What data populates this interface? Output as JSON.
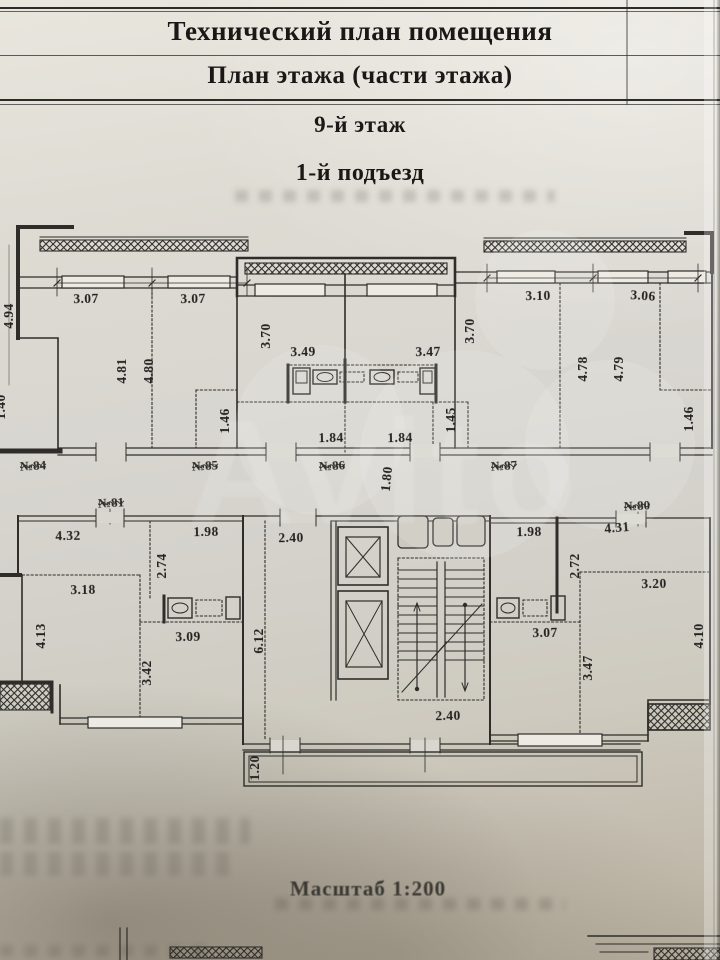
{
  "header": {
    "title": "Технический план помещения",
    "subtitle": "План этажа (части этажа)",
    "floor": "9-й этаж",
    "entrance": "1-й подъезд"
  },
  "footer": {
    "scale": "Масштаб 1:200"
  },
  "watermark": {
    "text": "Avito"
  },
  "plan": {
    "apartments": {
      "a84": "№84",
      "a85": "№85",
      "a86": "№86",
      "a87": "№87",
      "a81": "№81",
      "a80": "№80"
    },
    "dims": {
      "u_494": "4.94",
      "u_307a": "3.07",
      "u_307b": "3.07",
      "u_370a": "3.70",
      "u_349": "3.49",
      "u_347": "3.47",
      "u_370b": "3.70",
      "u_310": "3.10",
      "u_306": "3.06",
      "u_481": "4.81",
      "u_480": "4.80",
      "u_478": "4.78",
      "u_479": "4.79",
      "u_140": "1.40",
      "u_146a": "1.46",
      "u_184a": "1.84",
      "u_184b": "1.84",
      "u_145": "1.45",
      "u_146b": "1.46",
      "u_180": "1.80",
      "l_432": "4.32",
      "l_198a": "1.98",
      "l_240a": "2.40",
      "l_198b": "1.98",
      "l_431": "4.31",
      "l_274": "2.74",
      "l_272": "2.72",
      "l_318": "3.18",
      "l_320": "3.20",
      "l_413": "4.13",
      "l_342": "3.42",
      "l_309": "3.09",
      "l_612": "6.12",
      "l_307": "3.07",
      "l_347": "3.47",
      "l_410": "4.10",
      "l_240b": "2.40",
      "l_120": "1.20"
    }
  }
}
